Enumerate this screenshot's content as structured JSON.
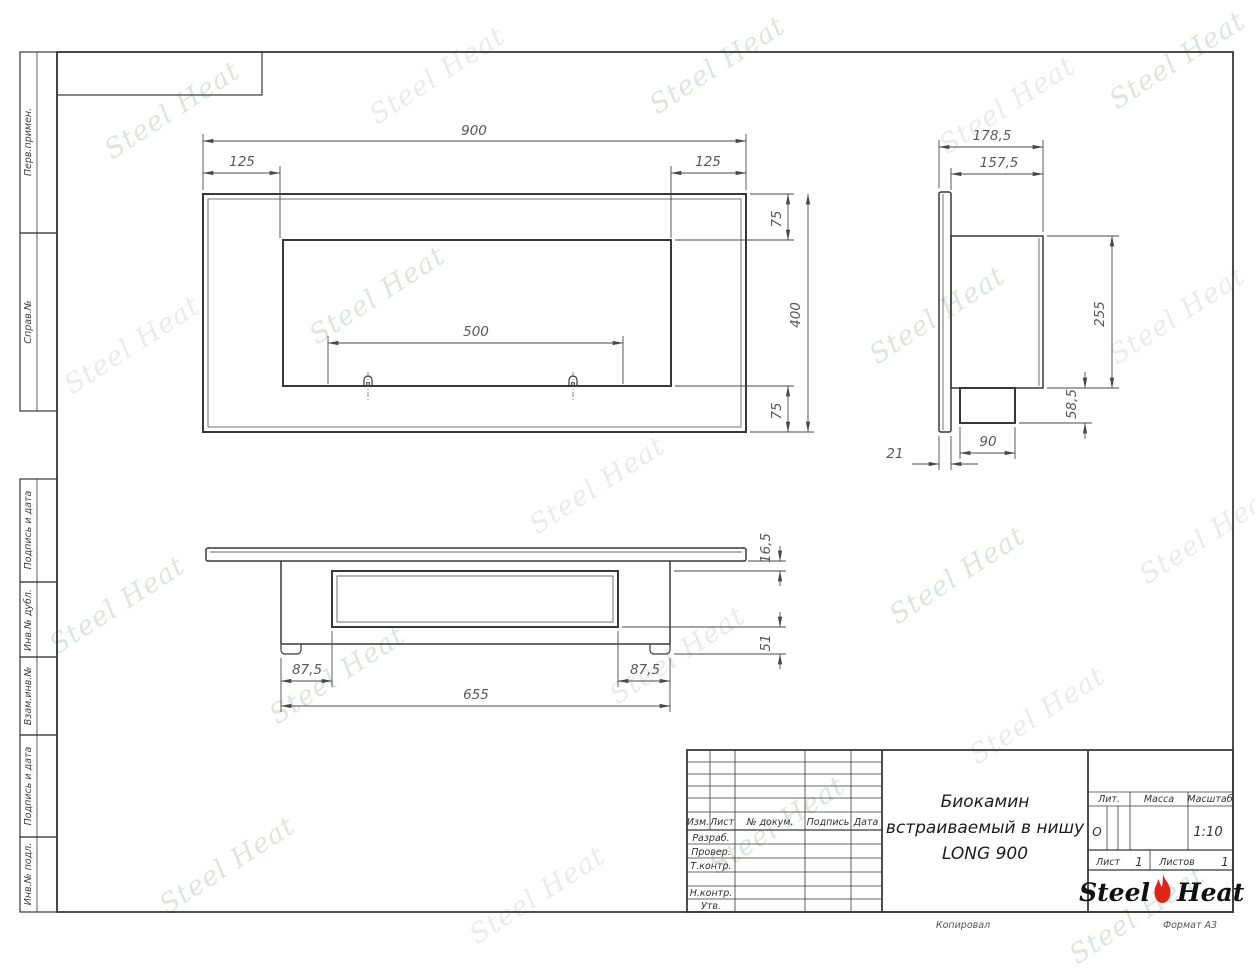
{
  "watermark": {
    "text": "Steel Heat"
  },
  "margin_labels": {
    "perv_primen": "Перв.примен.",
    "sprav_no": "Справ.№",
    "podpis_data_1": "Подпись и дата",
    "inv_dubl": "Инв.№ дубл.",
    "vzam_inv": "Взам.инв.№",
    "podpis_data_2": "Подпись и дата",
    "inv_podl": "Инв.№ подл."
  },
  "views": {
    "front": {
      "dim_width": "900",
      "dim_left_inset": "125",
      "dim_right_inset": "125",
      "dim_slot": "500",
      "dim_top_inset": "75",
      "dim_height": "400",
      "dim_bottom_inset": "75"
    },
    "side": {
      "dim_depth_total": "178,5",
      "dim_depth_box": "157,5",
      "dim_box_height": "255",
      "dim_tray_height": "58,5",
      "dim_tray_width": "90",
      "dim_flange": "21"
    },
    "bottom": {
      "dim_plate": "16,5",
      "dim_inset_left": "87,5",
      "dim_inset_right": "87,5",
      "dim_length": "655",
      "dim_foot": "51"
    }
  },
  "title_block": {
    "cols": {
      "izm": "Изм.",
      "list": "Лист",
      "doc": "№ докум.",
      "podpis": "Подпись",
      "data": "Дата"
    },
    "rows": {
      "razrab": "Разраб.",
      "prover": "Провер.",
      "tkontr": "Т.контр.",
      "nkontr": "Н.контр.",
      "utv": "Утв."
    },
    "name_line1": "Биокамин",
    "name_line2": "встраиваемый в нишу",
    "name_line3": "LONG 900",
    "lit_label": "Лит.",
    "lit_value": "О",
    "massa_label": "Масса",
    "masshtab_label": "Масштаб",
    "scale_value": "1:10",
    "list_label": "Лист",
    "list_value": "1",
    "listov_label": "Листов",
    "listov_value": "1",
    "brand_steel": "Steel",
    "brand_heat": "Heat"
  },
  "footer": {
    "kopiroval": "Копировал",
    "format": "Формат А3"
  },
  "colors": {
    "line": "#3a3a3a",
    "dim_text": "#585858",
    "brand_red": "#df2317",
    "watermark": "#91aa96"
  }
}
